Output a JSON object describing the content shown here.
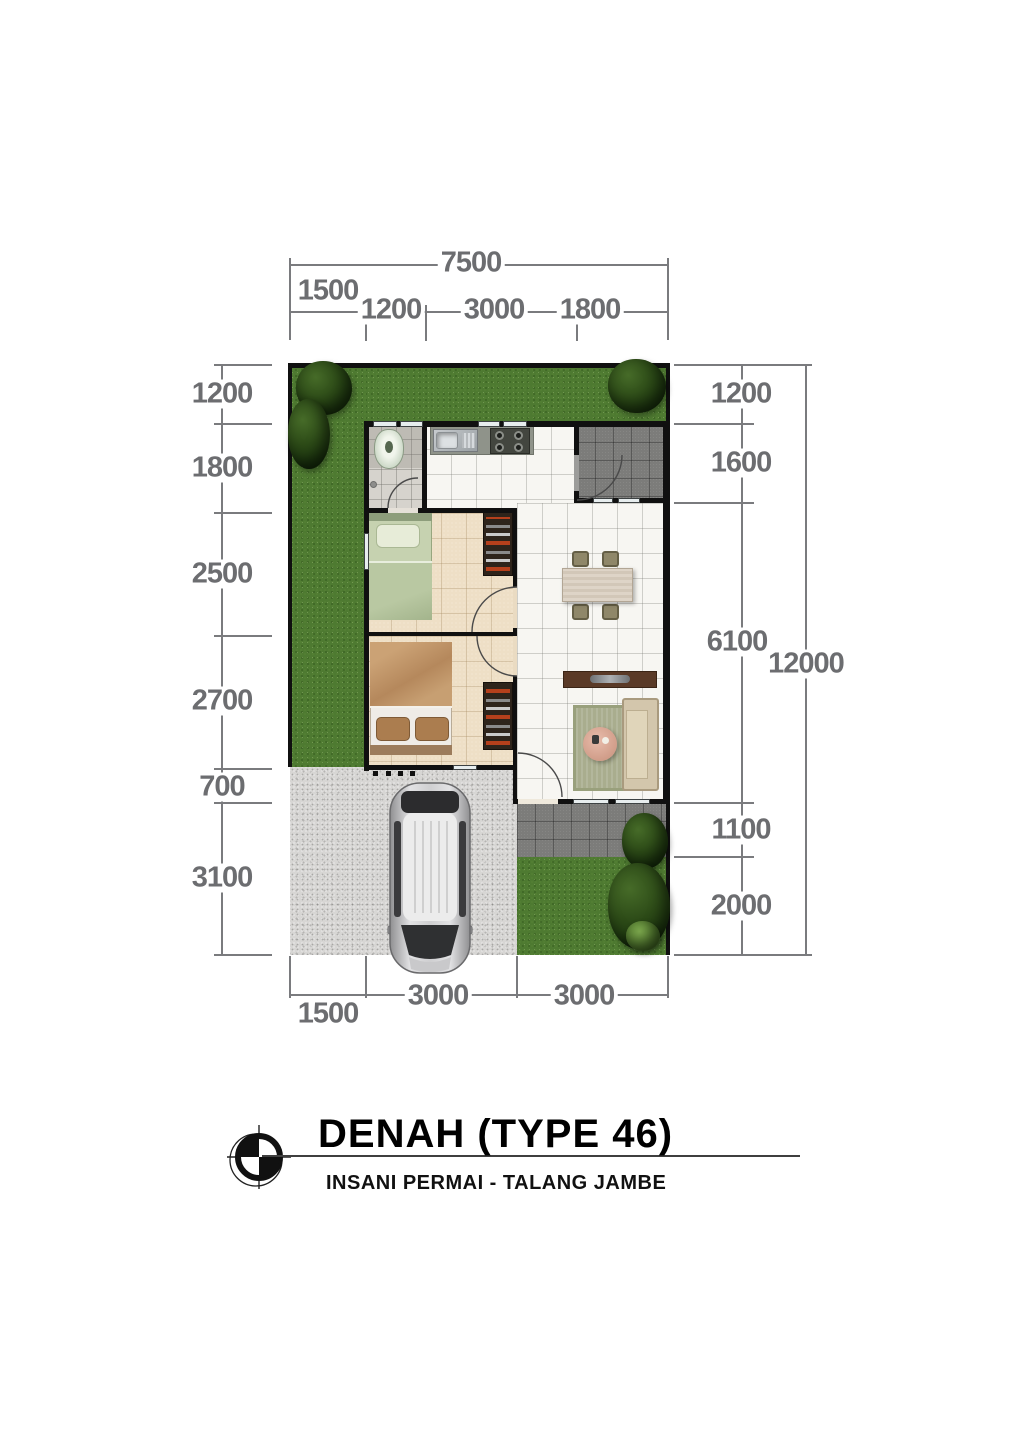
{
  "title_block": {
    "title": "DENAH (TYPE 46)",
    "subtitle": "INSANI PERMAI - TALANG JAMBE"
  },
  "dimensions": {
    "top": {
      "total": "7500",
      "segments": [
        "1500",
        "1200",
        "3000",
        "1800"
      ]
    },
    "left": {
      "segments": [
        "1200",
        "1800",
        "2500",
        "2700",
        "700",
        "3100"
      ]
    },
    "right": {
      "total": "12000",
      "segments": [
        "1200",
        "1600",
        "6100",
        "1100",
        "2000"
      ]
    },
    "bottom": {
      "segments": [
        "1500",
        "3000",
        "3000"
      ]
    }
  },
  "colors": {
    "dimension_text": "#6c6d70",
    "wall": "#101010",
    "grass": "#4e7a31",
    "gravel": "#d7d6d4",
    "terrace_tile": "#7c7c7a",
    "interior_tile": "#f7f6f2",
    "bedroom_tile": "#eedfc6",
    "bathroom_tile": "#d6d3cd",
    "title_text": "#000000"
  }
}
